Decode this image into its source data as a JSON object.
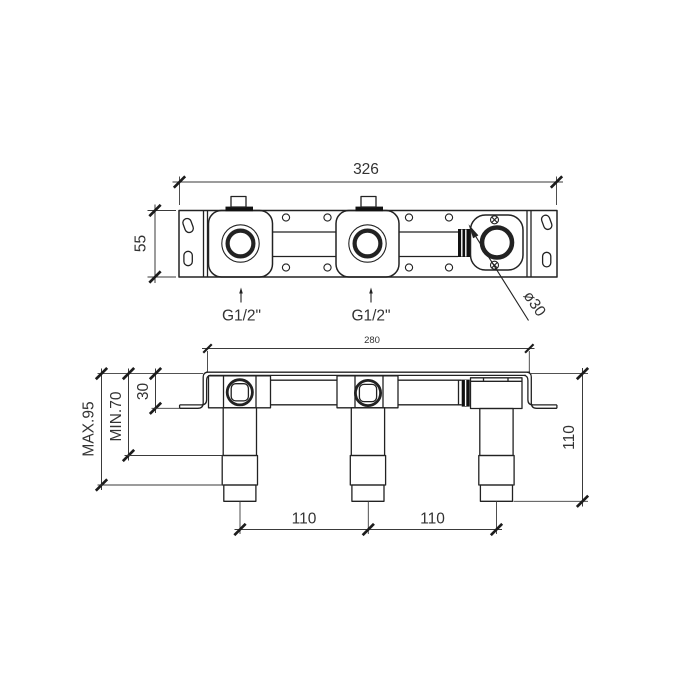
{
  "view_top": {
    "dim_overall_width": "326",
    "dim_overall_height": "55",
    "port_label_left": "G1/2\"",
    "port_label_center": "G1/2\"",
    "callout_diameter": "ø30"
  },
  "view_front": {
    "dim_body_width": "280",
    "dim_flange_depth": "30",
    "dim_depth_min": "MIN.70",
    "dim_depth_max": "MAX.95",
    "dim_overall_height": "110",
    "dim_port_spacing_left": "110",
    "dim_port_spacing_right": "110"
  },
  "colors": {
    "line": "#222222",
    "text": "#333333",
    "background": "#ffffff",
    "seal_fill": "#111111"
  }
}
